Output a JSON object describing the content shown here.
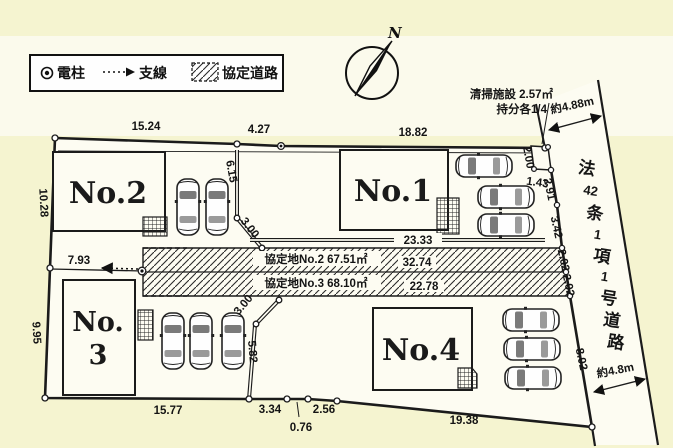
{
  "colors": {
    "background": "#f5f4d0",
    "paper": "#fbfaec",
    "surface": "#fdfcf2",
    "line": "#1b1b1b"
  },
  "legend": {
    "pole": "電柱",
    "wire": "支線",
    "agreement_road": "協定道路"
  },
  "compass": {
    "north": "N"
  },
  "notes": {
    "cleaning_facility": "清掃施設 2.57㎡",
    "share": "持分各1/4"
  },
  "road": {
    "name": "法42条1項1号道路",
    "chars": [
      "法",
      "42",
      "条",
      "1",
      "項",
      "1",
      "号",
      "道",
      "路"
    ],
    "width_top": "約4.88m",
    "width_bottom": "約4.8m"
  },
  "lots": {
    "no1": "No.1",
    "no2": "No.2",
    "no3_top": "No.",
    "no3_bottom": "3",
    "no4": "No.4"
  },
  "agreement": {
    "row1": "協定地No.2 67.51㎡",
    "row1_len": "32.74",
    "row2": "協定地No.3 68.10㎡",
    "row2_len": "22.78"
  },
  "dims": {
    "top_no2": "15.24",
    "top_mid": "4.27",
    "top_no1": "18.82",
    "left_up": "10.28",
    "left_low": "9.95",
    "bot_no3": "15.77",
    "bot_a": "3.34",
    "bot_b": "2.56",
    "bot_c": "0.76",
    "bot_no4": "19.38",
    "wire_len": "7.93",
    "no2_e": "6.15",
    "no2_d": "3.00",
    "no1_s": "23.33",
    "no4_d": "3.00",
    "no4_e": "5.82",
    "fac_h": "2.00",
    "fac_w": "1.43",
    "e1": "2.91",
    "e2": "3.42",
    "e3": "2.02",
    "e4": "2.02",
    "e5": "8.02"
  }
}
